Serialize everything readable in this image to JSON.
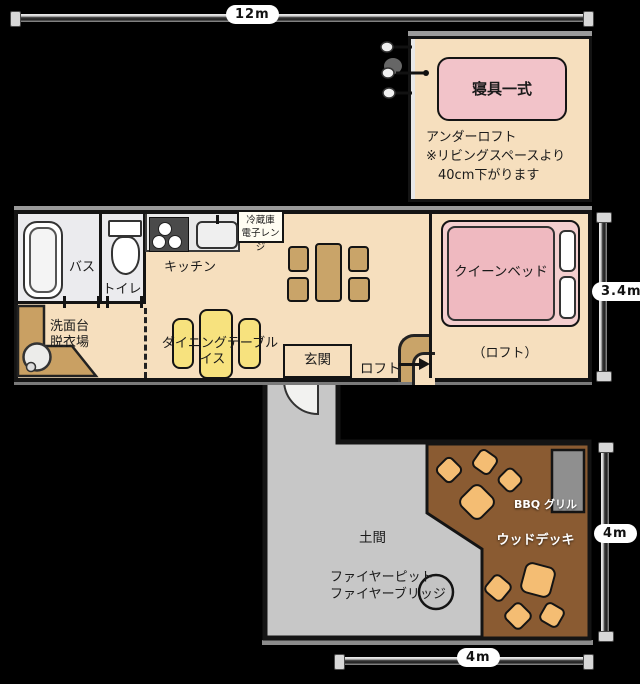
{
  "dimensions": {
    "top_width": "12m",
    "main_height": "3.4m",
    "wing_width": "4m",
    "wing_height": "4m"
  },
  "underloft": {
    "bedding_label": "寝具一式",
    "note_line1": "アンダーロフト",
    "note_line2": "※リビングスペースより",
    "note_line3": "40cm下がります"
  },
  "main_floor": {
    "bath": "バス",
    "toilet": "トイレ",
    "kitchen": "キッチン",
    "fridge": "冷蔵庫",
    "microwave": "電子レンジ",
    "washstand": "洗面台",
    "dressing_room": "脱衣場",
    "dining_table": "ダイニングテーブル",
    "chair": "イス",
    "entrance": "玄関",
    "loft": "ロフト",
    "queen_bed": "クイーンベッド",
    "loft_paren": "（ロフト）"
  },
  "wing": {
    "doma": "土間",
    "firepit_line1": "ファイヤーピット",
    "firepit_line2": "ファイヤーブリッジ",
    "wood_deck": "ウッドデッキ",
    "bbq_grill": "BBQ グリル"
  },
  "colors": {
    "floor_beige": "#F6DFBE",
    "room_gray": "#EBEBEE",
    "counter_tan": "#C9A063",
    "dining_yellow": "#F7E27E",
    "wood_brown": "#C9A469",
    "bed_pink": "#EFB9C0",
    "bed_frame_pink": "#F4CFCF",
    "bedding_pink": "#F2C3C9",
    "deck_brown": "#8A5B32",
    "cushion_orange": "#F4BD73",
    "doma_gray": "#C7C7C7",
    "background": "#000000"
  }
}
